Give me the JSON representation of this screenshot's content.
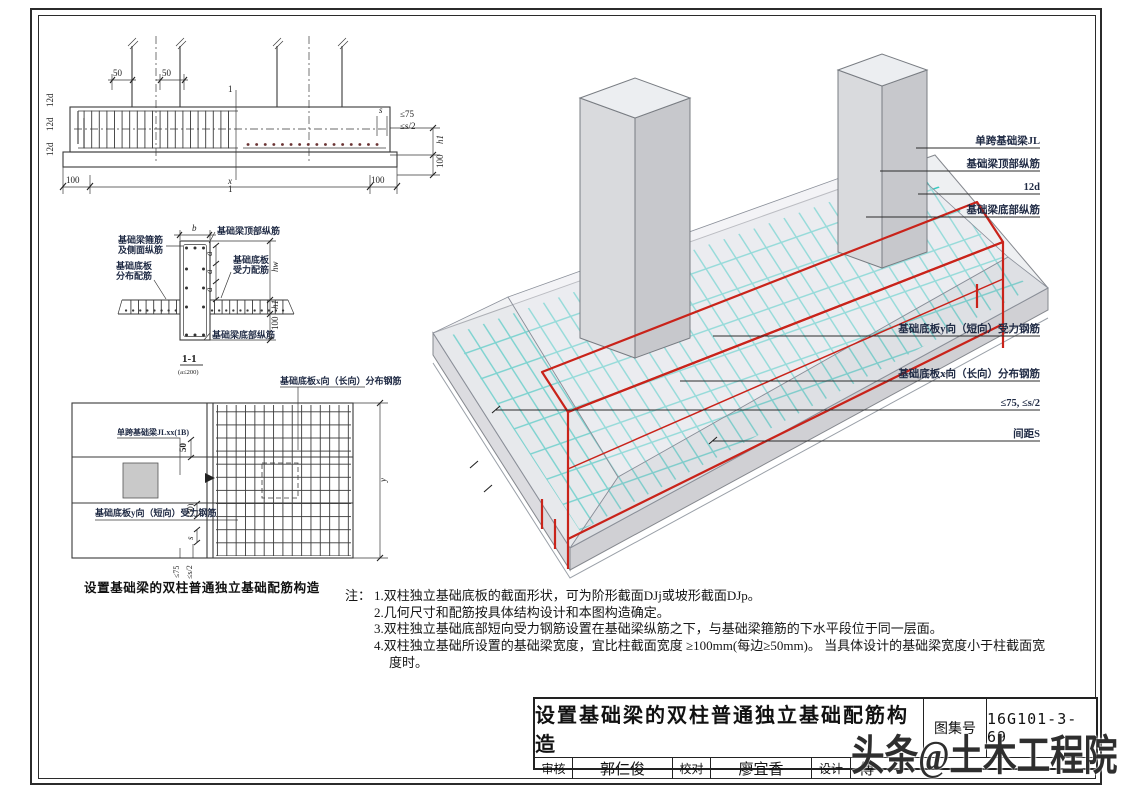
{
  "colors": {
    "ink": "#3a3a3a",
    "rebar": "#c9231a",
    "mesh": "#31c9c0",
    "ann": "#1f2a44",
    "concrete": "#e9e9ec"
  },
  "elevation": {
    "dim_50_left": "50",
    "dim_50_right": "50",
    "cut_label_top": "1",
    "cut_label_bottom": "1",
    "hook_12d": [
      "12d",
      "12d",
      "12d"
    ],
    "dim_le75": "≤75",
    "dim_le_s2": "≤s/2",
    "dim_s": "s",
    "dim_h1": "h1",
    "dim_100_side": "100",
    "dim_100_left": "100",
    "dim_x": "x",
    "dim_100_right": "100"
  },
  "section": {
    "dim_b": "b",
    "label_top_bars": "基础梁顶部纵筋",
    "label_stirrup_line1": "基础梁箍筋",
    "label_stirrup_line2": "及侧面纵筋",
    "label_dist_line1": "基础底板",
    "label_dist_line2": "分布配筋",
    "label_force_line1": "基础底板",
    "label_force_line2": "受力配筋",
    "label_bottom_bars": "基础梁底部纵筋",
    "dim_a": [
      "a",
      "a",
      "a"
    ],
    "dim_hw": "hw",
    "dim_h1": "h1",
    "dim_100": "100",
    "view_title": "1-1",
    "view_note": "(a≤200)"
  },
  "plan": {
    "label_dist_bars": "基础底板x向（长向）分布钢筋",
    "label_beam": "单跨基础梁JLxx(1B)",
    "dim_50": "50",
    "label_force_bars": "基础底板y向（短向）受力钢筋",
    "dim_y": "y",
    "dim_50_paren": "(50)",
    "dim_s": "s",
    "dim_le75": "≤75",
    "dim_le_s2": "≤s/2"
  },
  "iso": {
    "labels": [
      "单跨基础梁JL",
      "基础梁顶部纵筋",
      "12d",
      "基础梁底部纵筋",
      "基础底板y向（短向）受力钢筋",
      "基础底板x向（长向）分布钢筋",
      "≤75, ≤s/2",
      "间距S"
    ]
  },
  "caption": "设置基础梁的双柱普通独立基础配筋构造",
  "notes": {
    "prefix": "注：",
    "items": [
      "1.双柱独立基础底板的截面形状，可为阶形截面DJj或坡形截面DJp。",
      "2.几何尺寸和配筋按具体结构设计和本图构造确定。",
      "3.双柱独立基础底部短向受力钢筋设置在基础梁纵筋之下，与基础梁箍筋的下水平段位于同一层面。",
      "4.双柱独立基础所设置的基础梁宽度，宜比柱截面宽度 ≥100mm(每边≥50mm)。 当具体设计的基础梁宽度小于柱截面宽度时。"
    ]
  },
  "titleblock": {
    "title": "设置基础梁的双柱普通独立基础配筋构造",
    "atlas_label": "图集号",
    "atlas_no": "16G101-3-69",
    "review_label": "审核",
    "reviewer": "郭仁俊",
    "proof_label": "校对",
    "proofreader": "廖宜香",
    "design_label": "设计",
    "designer": "傅"
  },
  "watermark": "头条@土木工程院"
}
